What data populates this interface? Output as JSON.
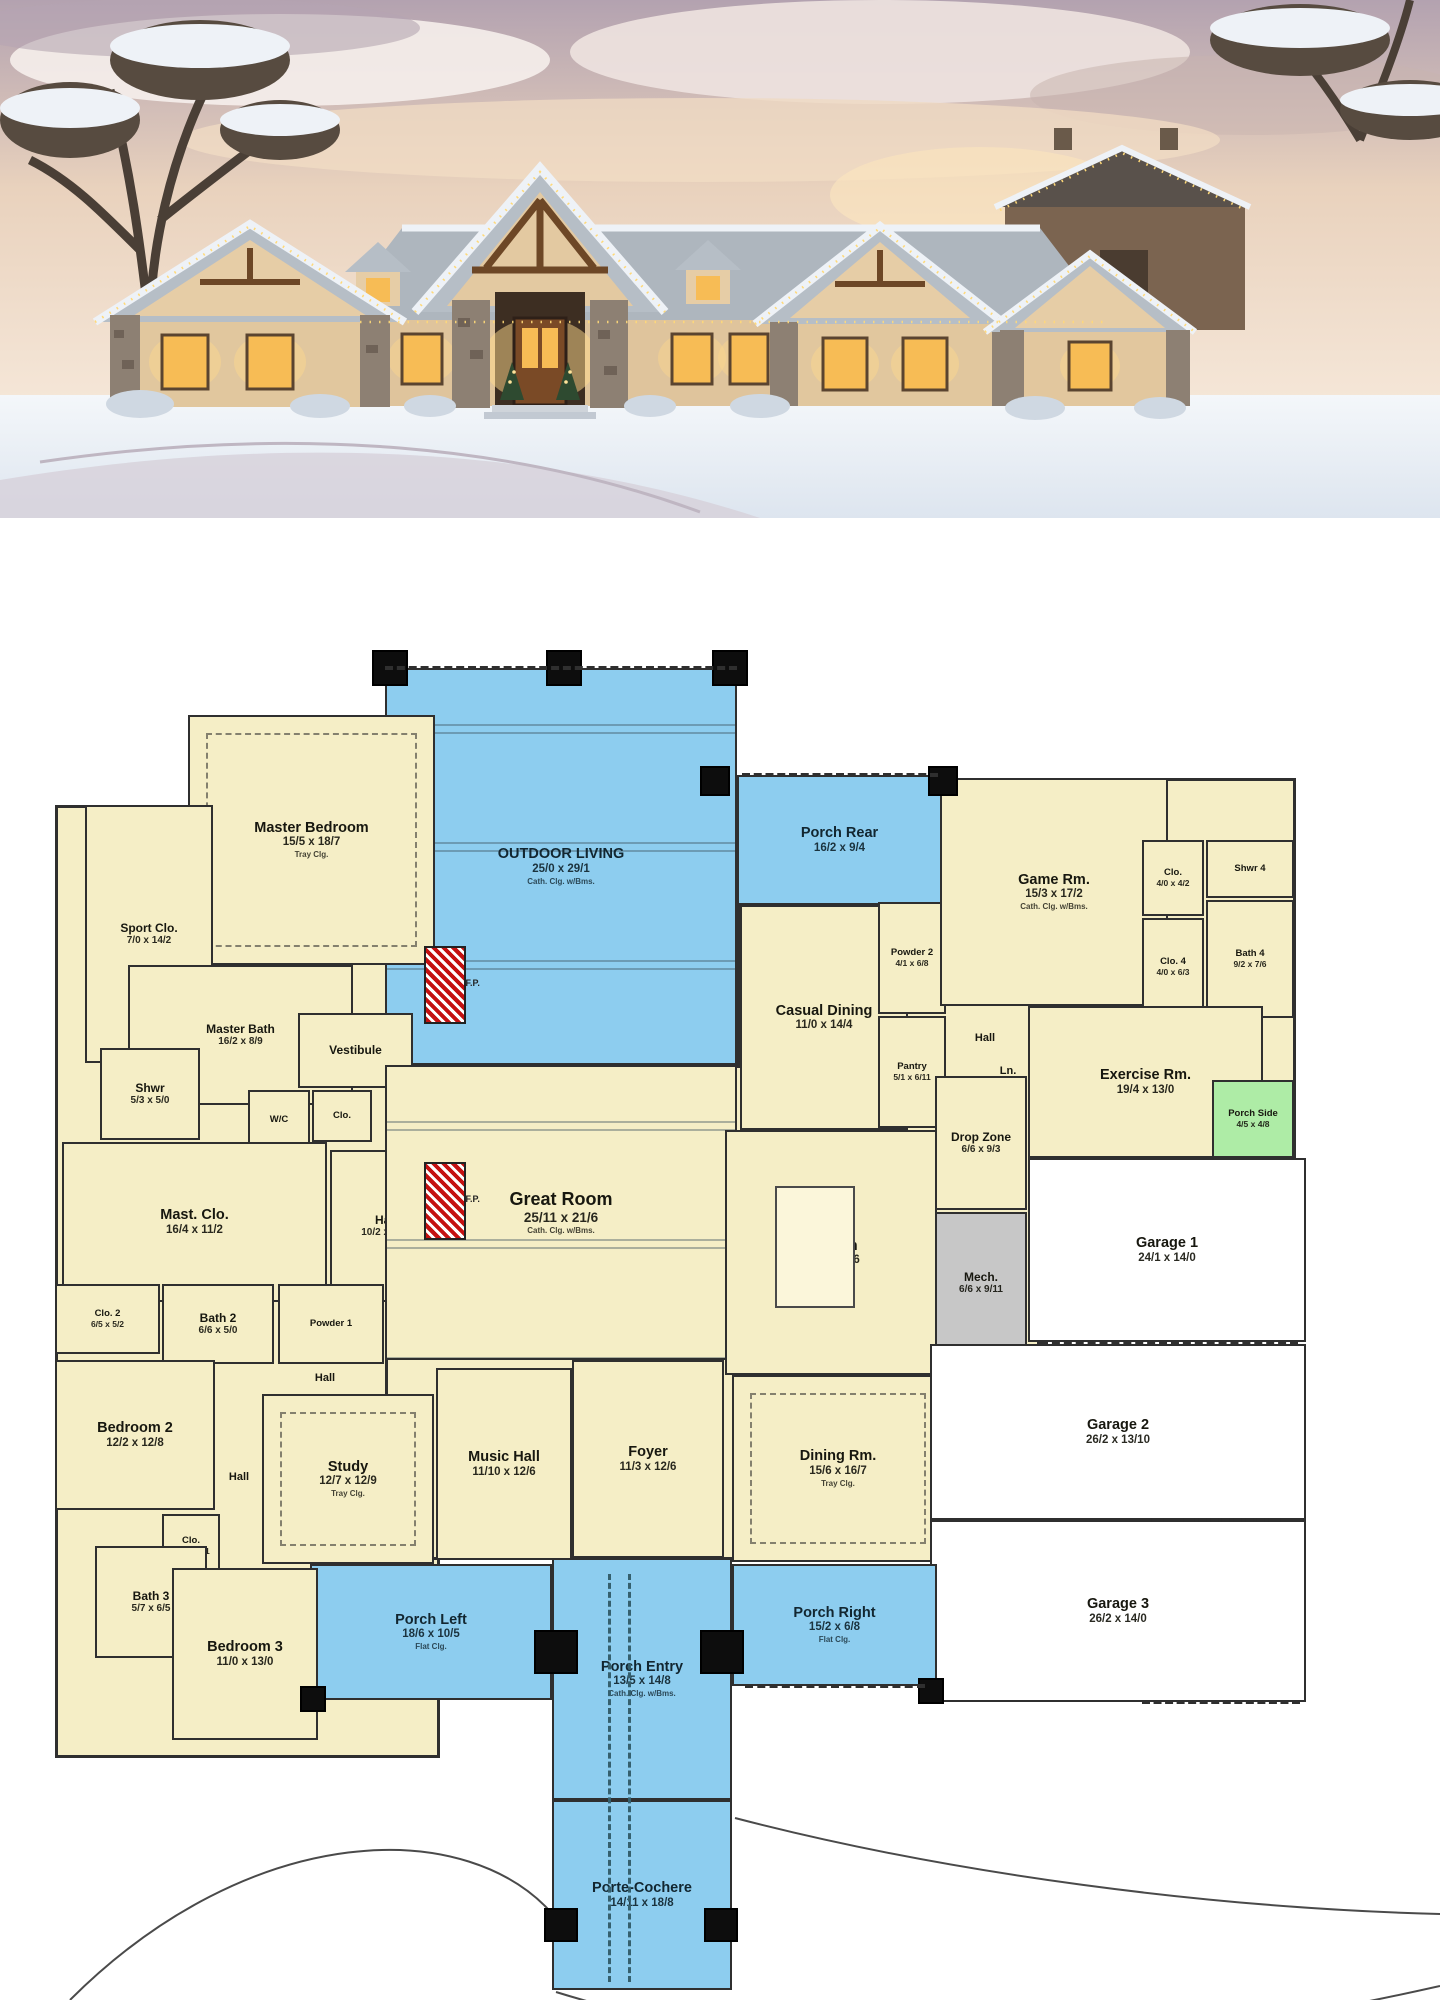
{
  "photo": {
    "scene": "snowy ranch house at dusk with warm lit windows and holiday roof lights",
    "colors": {
      "sky_top": "#b3a2b0",
      "sky_mid": "#e9d2bd",
      "sky_low": "#f6e8da",
      "snow": "#eef2f7",
      "roof": "#b4bcc4",
      "stucco": "#e1c79e",
      "stone": "#8d8073",
      "truss": "#6d4726",
      "window_warm": "#f7bc55",
      "glow": "#ffd98c",
      "tree": "#4a3f36",
      "barn": "#7b6450"
    }
  },
  "plan": {
    "wall_color": "#2f2f2f",
    "colors": {
      "room": "#f5eec6",
      "porch": "#8dcdef",
      "green": "#aeeca6",
      "mech": "#c7c7c7",
      "garage": "#ffffff"
    },
    "fireplace_label": "F.P.",
    "base": [
      {
        "x": 55,
        "y": 287,
        "w": 385,
        "h": 953
      },
      {
        "x": 188,
        "y": 197,
        "w": 250,
        "h": 95
      },
      {
        "x": 385,
        "y": 547,
        "w": 560,
        "h": 495
      },
      {
        "x": 737,
        "y": 387,
        "w": 208,
        "h": 162
      },
      {
        "x": 940,
        "y": 260,
        "w": 356,
        "h": 380
      },
      {
        "x": 905,
        "y": 384,
        "w": 135,
        "h": 455
      }
    ],
    "rooms": [
      {
        "id": "outdoor-living",
        "name": "OUTDOOR LIVING",
        "dims": "25/0 x 29/1",
        "note": "Cath. Clg. w/Bms.",
        "type": "porch",
        "size": "md",
        "beams": true,
        "x": 385,
        "y": 150,
        "w": 352,
        "h": 397
      },
      {
        "id": "porch-rear",
        "name": "Porch Rear",
        "dims": "16/2 x 9/4",
        "type": "porch",
        "size": "md",
        "x": 737,
        "y": 257,
        "w": 205,
        "h": 130
      },
      {
        "id": "master-bedroom",
        "name": "Master Bedroom",
        "dims": "15/5 x 18/7",
        "note": "Tray Clg.",
        "type": "cream",
        "size": "md",
        "tray": true,
        "x": 188,
        "y": 197,
        "w": 247,
        "h": 250
      },
      {
        "id": "sport-clo",
        "name": "Sport Clo.",
        "dims": "7/0 x 14/2",
        "type": "cream",
        "size": "sm",
        "x": 85,
        "y": 287,
        "w": 128,
        "h": 258
      },
      {
        "id": "master-bath",
        "name": "Master Bath",
        "dims": "16/2 x 8/9",
        "type": "cream",
        "size": "sm",
        "x": 128,
        "y": 447,
        "w": 225,
        "h": 140
      },
      {
        "id": "shwr",
        "name": "Shwr",
        "dims": "5/3 x 5/0",
        "type": "cream",
        "size": "sm",
        "x": 100,
        "y": 530,
        "w": 100,
        "h": 92
      },
      {
        "id": "vestibule",
        "name": "Vestibule",
        "type": "cream",
        "size": "sm",
        "x": 298,
        "y": 495,
        "w": 115,
        "h": 75
      },
      {
        "id": "wc",
        "name": "W/C",
        "type": "cream",
        "size": "xs",
        "x": 248,
        "y": 572,
        "w": 62,
        "h": 60
      },
      {
        "id": "clo-wc",
        "name": "Clo.",
        "type": "cream",
        "size": "xs",
        "x": 312,
        "y": 572,
        "w": 60,
        "h": 52
      },
      {
        "id": "mast-clo",
        "name": "Mast. Clo.",
        "dims": "16/4 x 11/2",
        "type": "cream",
        "size": "md",
        "x": 62,
        "y": 624,
        "w": 265,
        "h": 160
      },
      {
        "id": "hall-master",
        "name": "Hall",
        "dims": "10/2 x 11/2",
        "type": "cream",
        "size": "sm",
        "x": 330,
        "y": 632,
        "w": 112,
        "h": 152
      },
      {
        "id": "clo-2",
        "name": "Clo. 2",
        "dims": "6/5 x 5/2",
        "type": "cream",
        "size": "xs",
        "x": 55,
        "y": 766,
        "w": 105,
        "h": 70
      },
      {
        "id": "bath-2",
        "name": "Bath 2",
        "dims": "6/6 x 5/0",
        "type": "cream",
        "size": "sm",
        "x": 162,
        "y": 766,
        "w": 112,
        "h": 80
      },
      {
        "id": "powder-1",
        "name": "Powder 1",
        "type": "cream",
        "size": "xs",
        "x": 278,
        "y": 766,
        "w": 106,
        "h": 80
      },
      {
        "id": "bedroom-2",
        "name": "Bedroom 2",
        "dims": "12/2 x 12/8",
        "type": "cream",
        "size": "md",
        "x": 55,
        "y": 842,
        "w": 160,
        "h": 150
      },
      {
        "id": "hall-upper",
        "name": "Hall",
        "type": "lbl",
        "size": "xs",
        "x": 292,
        "y": 838,
        "w": 66,
        "h": 44
      },
      {
        "id": "hall-bed2",
        "name": "Hall",
        "type": "lbl",
        "size": "xs",
        "x": 208,
        "y": 938,
        "w": 62,
        "h": 42
      },
      {
        "id": "study",
        "name": "Study",
        "dims": "12/7 x 12/9",
        "note": "Tray Clg.",
        "type": "cream",
        "size": "md",
        "tray": true,
        "x": 262,
        "y": 876,
        "w": 172,
        "h": 170
      },
      {
        "id": "music-hall",
        "name": "Music Hall",
        "dims": "11/10 x 12/6",
        "type": "cream",
        "size": "md",
        "x": 436,
        "y": 850,
        "w": 136,
        "h": 192
      },
      {
        "id": "foyer",
        "name": "Foyer",
        "dims": "11/3 x 12/6",
        "type": "cream",
        "size": "md",
        "x": 572,
        "y": 842,
        "w": 152,
        "h": 198
      },
      {
        "id": "great-room",
        "name": "Great Room",
        "dims": "25/11 x 21/6",
        "note": "Cath. Clg. w/Bms.",
        "type": "cream",
        "size": "lg",
        "beams": true,
        "x": 385,
        "y": 547,
        "w": 352,
        "h": 295
      },
      {
        "id": "casual-dining",
        "name": "Casual Dining",
        "dims": "11/0 x 14/4",
        "type": "cream",
        "size": "md",
        "x": 740,
        "y": 387,
        "w": 168,
        "h": 225
      },
      {
        "id": "powder-2",
        "name": "Powder 2",
        "dims": "4/1 x 6/8",
        "type": "cream",
        "size": "xs",
        "x": 878,
        "y": 384,
        "w": 68,
        "h": 112
      },
      {
        "id": "pantry",
        "name": "Pantry",
        "dims": "5/1 x 6/11",
        "type": "cream",
        "size": "xs",
        "x": 878,
        "y": 498,
        "w": 68,
        "h": 112
      },
      {
        "id": "hall-kitchen",
        "name": "Hall",
        "type": "lbl",
        "size": "xs",
        "x": 952,
        "y": 500,
        "w": 66,
        "h": 40
      },
      {
        "id": "ln",
        "name": "Ln.",
        "type": "lbl",
        "size": "xs",
        "x": 986,
        "y": 540,
        "w": 44,
        "h": 26
      },
      {
        "id": "kitchen",
        "name": "Kitchen",
        "dims": "15/6 x 19/6",
        "type": "cream",
        "size": "md",
        "x": 725,
        "y": 612,
        "w": 212,
        "h": 245
      },
      {
        "id": "dining-rm",
        "name": "Dining Rm.",
        "dims": "15/6 x 16/7",
        "note": "Tray Clg.",
        "type": "cream",
        "size": "md",
        "tray": true,
        "x": 732,
        "y": 857,
        "w": 212,
        "h": 187
      },
      {
        "id": "game-rm",
        "name": "Game Rm.",
        "dims": "15/3 x 17/2",
        "note": "Cath. Clg. w/Bms.",
        "type": "cream",
        "size": "md",
        "x": 940,
        "y": 260,
        "w": 228,
        "h": 228
      },
      {
        "id": "clo-game",
        "name": "Clo.",
        "dims": "4/0 x 4/2",
        "type": "cream",
        "size": "xs",
        "x": 1142,
        "y": 322,
        "w": 62,
        "h": 76
      },
      {
        "id": "shwr-4",
        "name": "Shwr 4",
        "type": "cream",
        "size": "xs",
        "x": 1206,
        "y": 322,
        "w": 88,
        "h": 58
      },
      {
        "id": "clo-4",
        "name": "Clo. 4",
        "dims": "4/0 x 6/3",
        "type": "cream",
        "size": "xs",
        "x": 1142,
        "y": 400,
        "w": 62,
        "h": 98
      },
      {
        "id": "bath-4",
        "name": "Bath 4",
        "dims": "9/2 x 7/6",
        "type": "cream",
        "size": "xs",
        "x": 1206,
        "y": 382,
        "w": 88,
        "h": 118
      },
      {
        "id": "exercise-rm",
        "name": "Exercise Rm.",
        "dims": "19/4 x 13/0",
        "type": "cream",
        "size": "md",
        "x": 1028,
        "y": 488,
        "w": 235,
        "h": 152
      },
      {
        "id": "porch-side",
        "name": "Porch Side",
        "dims": "4/5 x 4/8",
        "type": "green",
        "size": "xs",
        "x": 1212,
        "y": 562,
        "w": 82,
        "h": 78
      },
      {
        "id": "drop-zone",
        "name": "Drop Zone",
        "dims": "6/6 x 9/3",
        "type": "cream",
        "size": "sm",
        "x": 935,
        "y": 558,
        "w": 92,
        "h": 134
      },
      {
        "id": "mech",
        "name": "Mech.",
        "dims": "6/6 x 9/11",
        "type": "mech",
        "size": "sm",
        "x": 935,
        "y": 694,
        "w": 92,
        "h": 142
      },
      {
        "id": "garage-1",
        "name": "Garage 1",
        "dims": "24/1 x 14/0",
        "type": "garage",
        "size": "md",
        "x": 1028,
        "y": 640,
        "w": 278,
        "h": 184
      },
      {
        "id": "garage-2",
        "name": "Garage 2",
        "dims": "26/2 x 13/10",
        "type": "garage",
        "size": "md",
        "x": 930,
        "y": 826,
        "w": 376,
        "h": 176
      },
      {
        "id": "garage-3",
        "name": "Garage 3",
        "dims": "26/2 x 14/0",
        "type": "garage",
        "size": "md",
        "x": 930,
        "y": 1002,
        "w": 376,
        "h": 182
      },
      {
        "id": "porch-entry",
        "name": "Porch Entry",
        "dims": "13/5 x 14/8",
        "note": "Cath. Clg. w/Bms.",
        "type": "porch",
        "size": "md",
        "x": 552,
        "y": 1040,
        "w": 180,
        "h": 242
      },
      {
        "id": "porch-left",
        "name": "Porch Left",
        "dims": "18/6 x 10/5",
        "note": "Flat Clg.",
        "type": "porch",
        "size": "md",
        "x": 310,
        "y": 1046,
        "w": 242,
        "h": 136
      },
      {
        "id": "porch-right",
        "name": "Porch Right",
        "dims": "15/2 x 6/8",
        "note": "Flat Clg.",
        "type": "porch",
        "size": "md",
        "x": 732,
        "y": 1046,
        "w": 205,
        "h": 122
      },
      {
        "id": "porte-cochere",
        "name": "Porte-Cochere",
        "dims": "14/11 x 18/8",
        "type": "porch",
        "size": "md",
        "x": 552,
        "y": 1282,
        "w": 180,
        "h": 190
      },
      {
        "id": "clo-3",
        "name": "Clo.",
        "dims": "2/6 x 3/11",
        "type": "cream",
        "size": "xs",
        "x": 162,
        "y": 996,
        "w": 58,
        "h": 64
      },
      {
        "id": "bath-3",
        "name": "Bath 3",
        "dims": "5/7 x 6/5",
        "type": "cream",
        "size": "sm",
        "x": 95,
        "y": 1028,
        "w": 112,
        "h": 112
      },
      {
        "id": "bedroom-3",
        "name": "Bedroom 3",
        "dims": "11/0 x 13/0",
        "type": "cream",
        "size": "md",
        "x": 172,
        "y": 1050,
        "w": 146,
        "h": 172
      }
    ],
    "posts": [
      {
        "x": 372,
        "y": 132,
        "s": 36
      },
      {
        "x": 546,
        "y": 132,
        "s": 36
      },
      {
        "x": 712,
        "y": 132,
        "s": 36
      },
      {
        "x": 700,
        "y": 248,
        "s": 30
      },
      {
        "x": 928,
        "y": 248,
        "s": 30
      },
      {
        "x": 300,
        "y": 1168,
        "s": 26
      },
      {
        "x": 534,
        "y": 1112,
        "s": 44
      },
      {
        "x": 700,
        "y": 1112,
        "s": 44
      },
      {
        "x": 544,
        "y": 1390,
        "s": 34
      },
      {
        "x": 704,
        "y": 1390,
        "s": 34
      },
      {
        "x": 918,
        "y": 1160,
        "s": 26
      }
    ],
    "fireplaces": [
      {
        "x": 424,
        "y": 428,
        "w": 42,
        "h": 78
      },
      {
        "x": 424,
        "y": 644,
        "w": 42,
        "h": 78
      }
    ],
    "hdash": [
      {
        "x": 385,
        "y": 148,
        "w": 352
      },
      {
        "x": 742,
        "y": 255,
        "w": 196
      },
      {
        "x": 1040,
        "y": 822,
        "w": 258
      },
      {
        "x": 1140,
        "y": 1000,
        "w": 160
      },
      {
        "x": 1142,
        "y": 1182,
        "w": 158
      },
      {
        "x": 745,
        "y": 1166,
        "w": 180
      }
    ],
    "vdash": [
      {
        "x": 608,
        "y": 1056,
        "h": 408
      },
      {
        "x": 628,
        "y": 1056,
        "h": 408
      }
    ],
    "island": {
      "x": 775,
      "y": 668,
      "w": 80,
      "h": 122
    }
  }
}
